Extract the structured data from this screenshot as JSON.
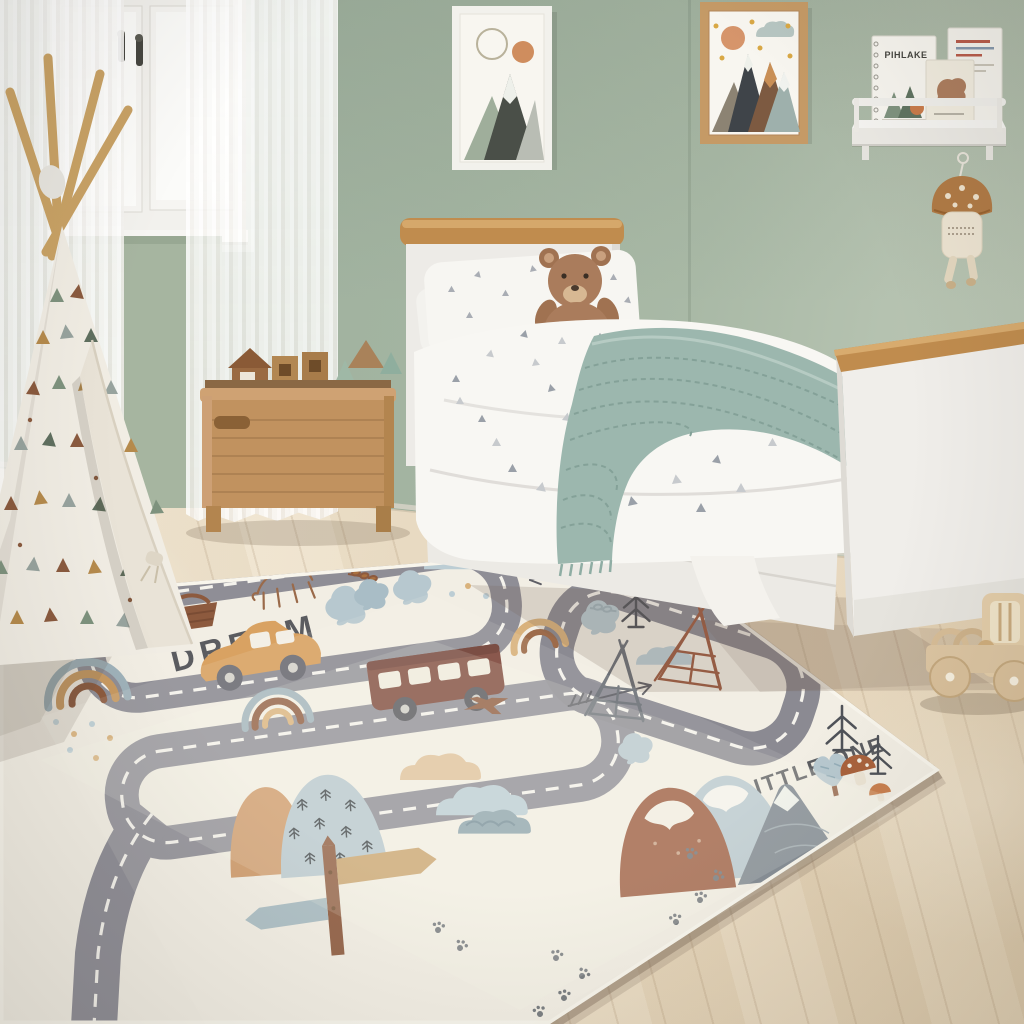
{
  "scene": {
    "name": "kids-bedroom-with-road-play-rug",
    "type": "photograph",
    "description": "Children's bedroom with sage green walls, white bed, play teepee, wooden toy box and a cream road-map play rug"
  },
  "texts": {
    "rug_word_dream": "DREAM",
    "rug_word_little_one": "LITTLE ONE",
    "book_title": "PIHLAKE"
  },
  "palette": {
    "wall_green": "#a3b4a1",
    "wall_green_light": "#bcc8b6",
    "floor_wood": "#eee2cc",
    "curtain_white": "#fbfbf9",
    "rug_cream": "#f1ede2",
    "road_gray": "#8f8e96",
    "road_dash_white": "#f4f2ec",
    "oak_wood": "#c08c4e",
    "toybox_wood": "#c1925f",
    "bed_white": "#efede9",
    "blanket_sage": "#9cb7ae",
    "teddy_brown": "#aa7c5c",
    "rug_rust": "#9d5b40",
    "rug_tan": "#cf9a6a",
    "rug_powder_blue": "#b7c8cf",
    "rug_brown": "#8d5a3e",
    "ink_gray": "#5b5c60",
    "frame_oak": "#c59a66",
    "mushroom_brown": "#b07a45"
  },
  "objects": {
    "window": "white-casement-window",
    "curtains": "sheer-white-curtains",
    "teepee": "play-teepee-with-triangle-pattern",
    "toy_box": "wooden-toy-chest-with-blocks",
    "bed": "white-single-bed-with-oak-trim",
    "teddy_bear": "plush-teddy-bear",
    "blanket": "sage-knit-throw-blanket",
    "wall_art_left": "framed-mountain-print-white-frame",
    "wall_art_right": "framed-mountain-print-oak-frame",
    "shelf": "white-picture-ledge-with-books",
    "mushroom_toy": "hanging-mushroom-plush",
    "play_rug": "cream-road-map-play-rug",
    "toy_truck": "wooden-toy-truck"
  },
  "rug": {
    "motifs": [
      "roads-with-dashed-center-lines",
      "rainbow",
      "car",
      "bus",
      "airplane-sketch",
      "arrow-sketches",
      "pine-tree-sketches",
      "bushy-trees",
      "clouds",
      "raindrops",
      "mountains-with-snow-caps",
      "teepee-sketches",
      "signpost",
      "paw-prints",
      "mushroom",
      "bear-sketch",
      "basket",
      "leaf-sprigs"
    ]
  }
}
